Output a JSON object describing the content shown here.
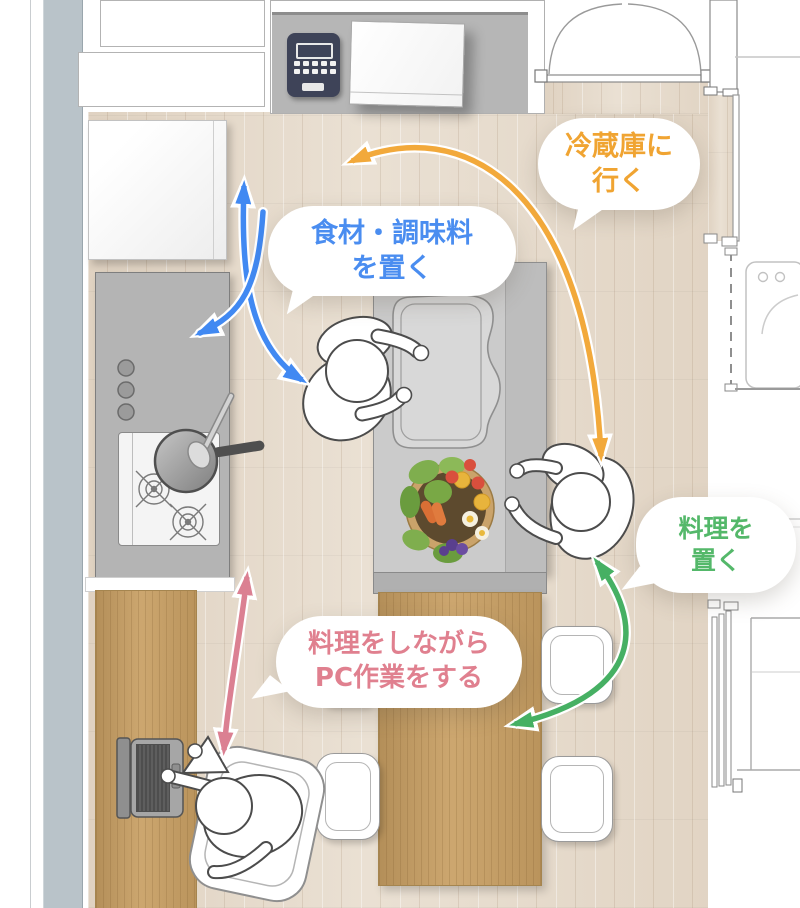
{
  "bubbles": {
    "go_to_fridge": {
      "line1": "冷蔵庫に",
      "line2": "行く",
      "text_color": "#f0a432"
    },
    "place_ingredients": {
      "line1": "食材・調味料",
      "line2": "を置く",
      "text_color": "#4a8df0"
    },
    "place_dish": {
      "line1": "料理を",
      "line2": "置く",
      "text_color": "#54b86a"
    },
    "pc_while_cooking": {
      "line1": "料理をしながら",
      "line2": "PC作業をする",
      "text_color": "#e0808f"
    }
  },
  "arrows": {
    "sink_to_fridge_roundtrip": {
      "color": "#4189f2"
    },
    "sink_to_counter": {
      "color": "#4189f2"
    },
    "fridge_route": {
      "color": "#f2a93b"
    },
    "serve_dish_to_table": {
      "color": "#46b063"
    },
    "desk_to_kitchen": {
      "color": "#db8092"
    }
  },
  "palette": {
    "floor": "#e7dccd",
    "wood": "#c89f63",
    "counter_gray": "#b6b6b6",
    "island_gray": "#cbcbcb",
    "wall_strip": "#b9c3c9",
    "appliance_navy": "#3e4358"
  },
  "objects": {
    "refrigerator": "refrigerator",
    "rice_cooker": "rice-cooker",
    "cutting_board": "cutting-board",
    "stove": "gas-stove",
    "frying_pan": "frying-pan",
    "sink": "kitchen-sink",
    "salad_plate": "salad-plate",
    "dining_table": "dining-table",
    "desk": "pc-desk",
    "laptop": "laptop",
    "washing_machine": "washing-machine"
  }
}
